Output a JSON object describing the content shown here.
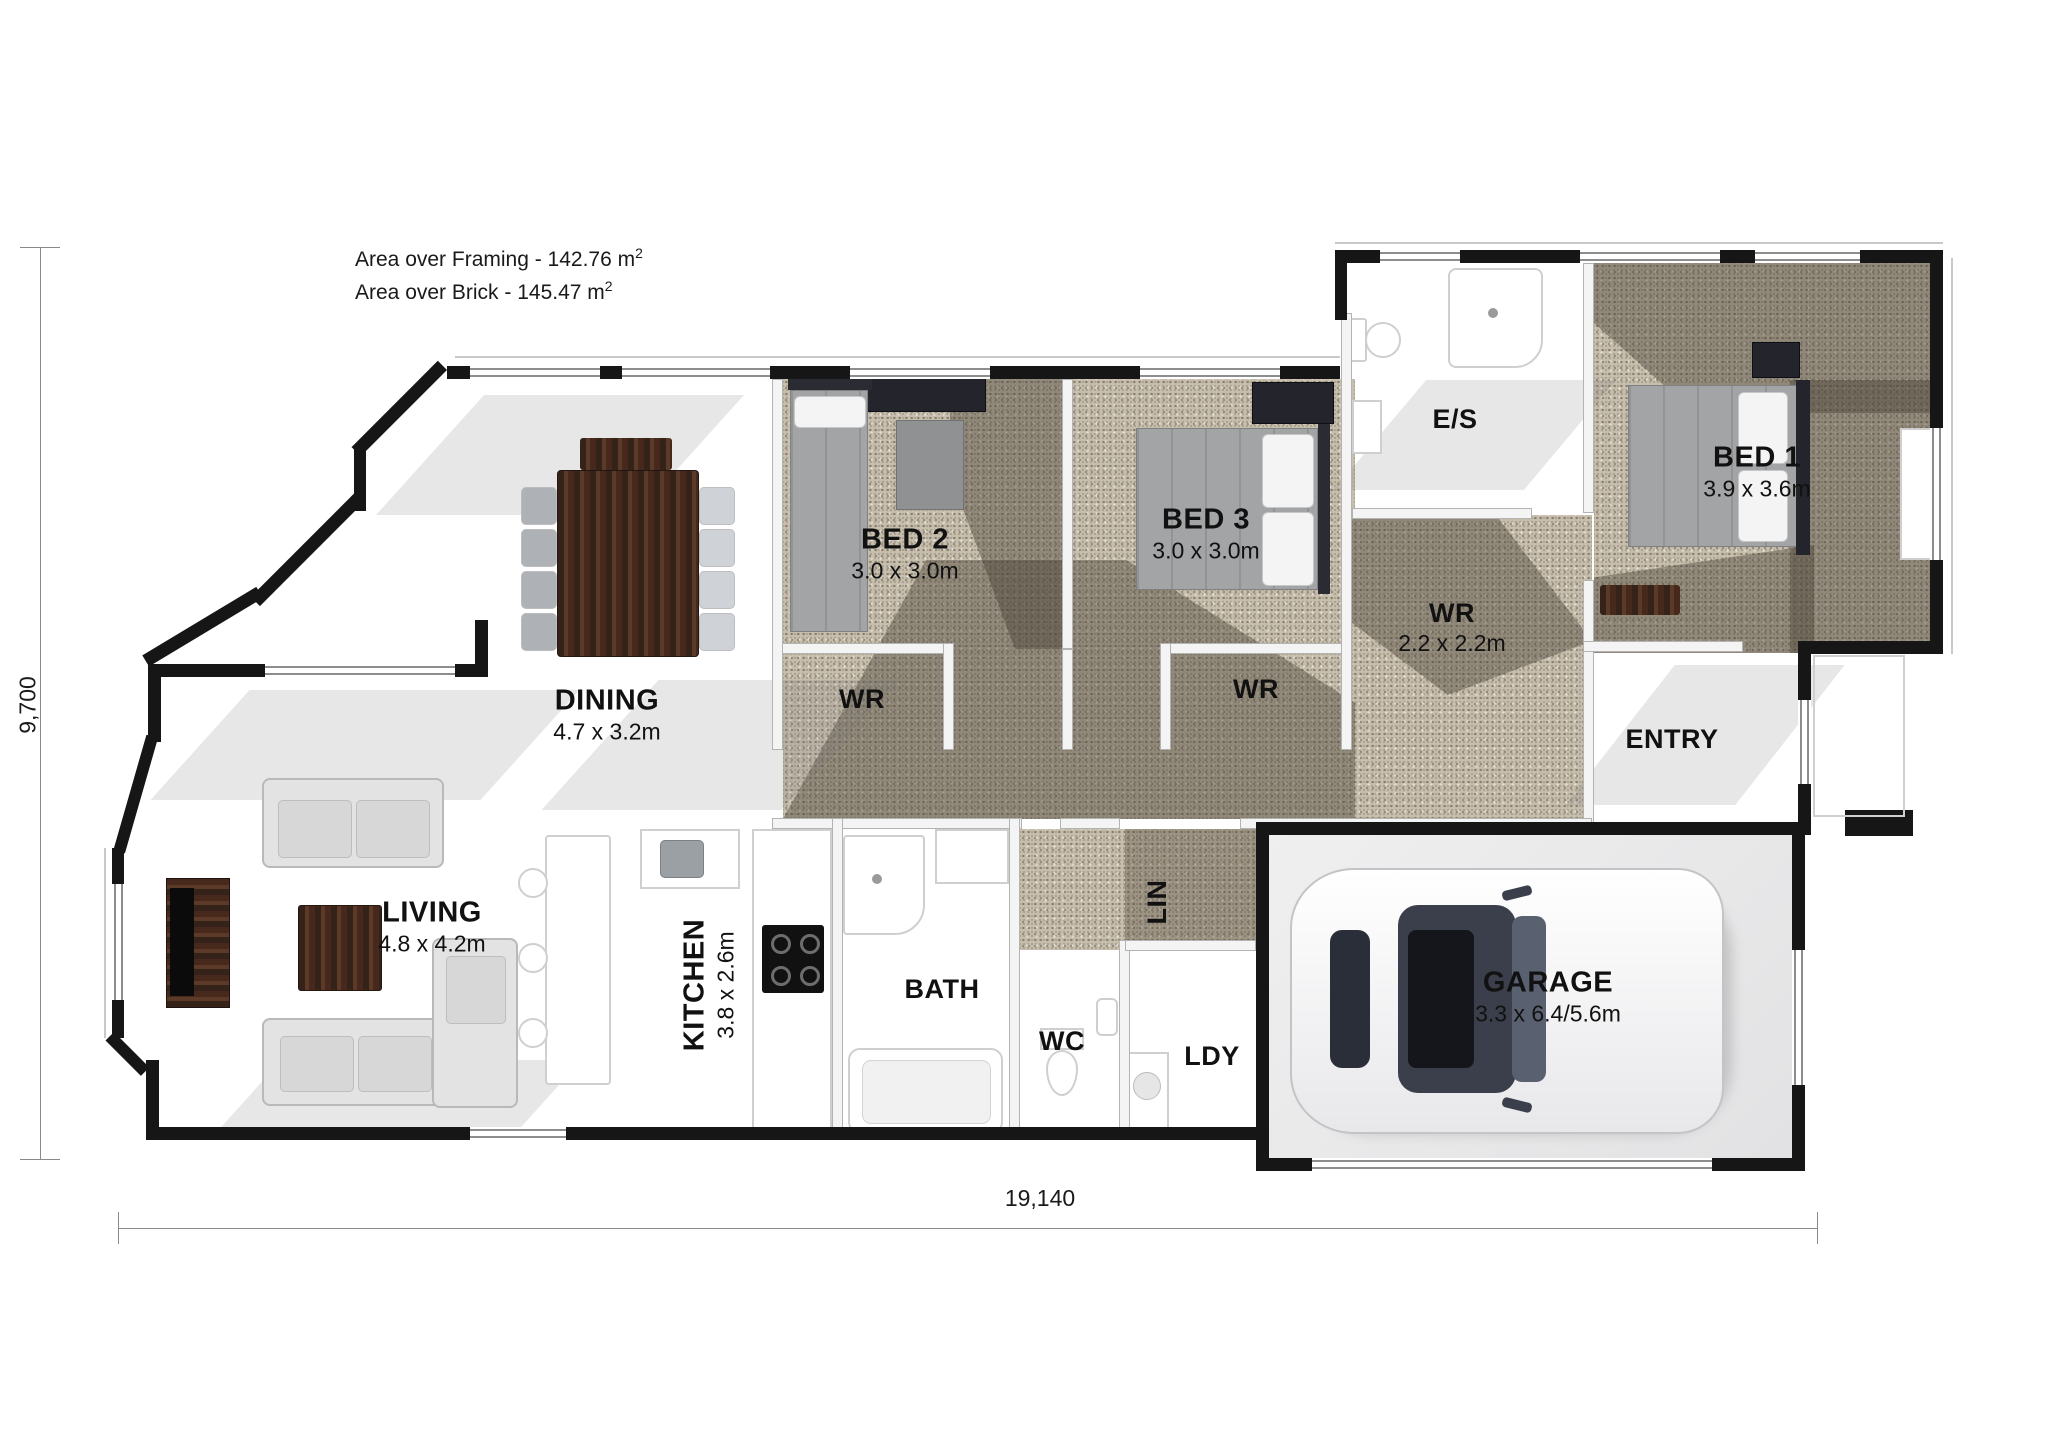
{
  "title_block": {
    "line1_text": "Area over Framing - 142.76 m",
    "line1_sup": "2",
    "line2_text": "Area over Brick - 145.47 m",
    "line2_sup": "2"
  },
  "dimension_labels": {
    "overall_width": "19,140",
    "overall_height": "9,700"
  },
  "rooms": {
    "bed1": {
      "name": "BED 1",
      "dims": "3.9 x 3.6m"
    },
    "bed2": {
      "name": "BED 2",
      "dims": "3.0 x 3.0m"
    },
    "bed3": {
      "name": "BED 3",
      "dims": "3.0 x 3.0m"
    },
    "ensuite": {
      "name": "E/S"
    },
    "wr_bed2": {
      "name": "WR"
    },
    "wr_bed3": {
      "name": "WR"
    },
    "wr_master": {
      "name": "WR",
      "dims": "2.2 x 2.2m"
    },
    "entry": {
      "name": "ENTRY"
    },
    "dining": {
      "name": "DINING",
      "dims": "4.7 x 3.2m"
    },
    "living": {
      "name": "LIVING",
      "dims": "4.8 x 4.2m"
    },
    "kitchen": {
      "name": "KITCHEN",
      "dims": "3.8 x 2.6m"
    },
    "bath": {
      "name": "BATH"
    },
    "wc": {
      "name": "WC"
    },
    "linen": {
      "name": "LIN"
    },
    "laundry": {
      "name": "LDY"
    },
    "garage": {
      "name": "GARAGE",
      "dims": "3.3 x 6.4/5.6m"
    }
  }
}
